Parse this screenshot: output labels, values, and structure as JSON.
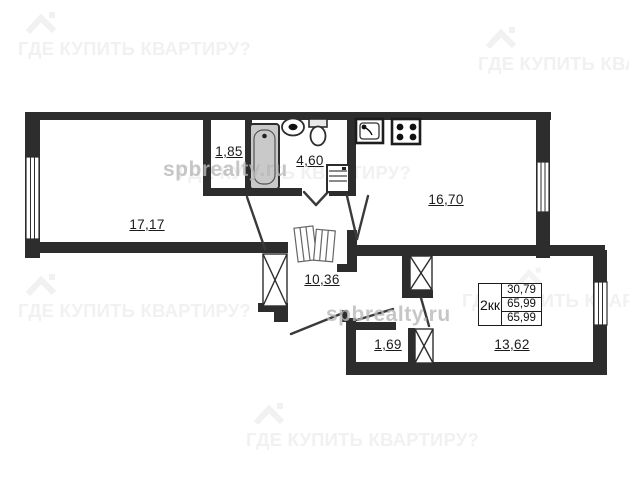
{
  "watermarks": {
    "question": "ГДЕ КУПИТЬ КВАРТИРУ?",
    "site": "spbrealty.ru"
  },
  "rooms": {
    "living": {
      "area": "17,17"
    },
    "hall": {
      "area": "1,85"
    },
    "bathroom": {
      "area": "4,60"
    },
    "kitchen": {
      "area": "16,70"
    },
    "corridor": {
      "area": "10,36"
    },
    "storage": {
      "area": "1,69"
    },
    "bedroom": {
      "area": "13,62"
    }
  },
  "info_table": {
    "apartment_type": "2кк",
    "living_area": "30,79",
    "total_area": "65,99",
    "total_area_repeat": "65,99"
  },
  "colors": {
    "wall": "#2d2d2d",
    "watermark_light": "#f1f1f1",
    "watermark_gray": "#b9b9b9"
  }
}
